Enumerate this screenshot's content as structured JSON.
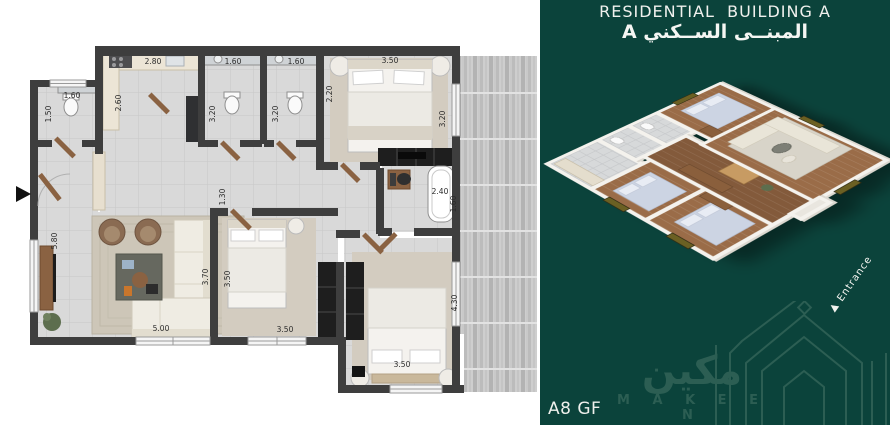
{
  "right_panel": {
    "title_en": "RESIDENTIAL  BUILDING A",
    "title_ar": "المبنــى الســكني A",
    "unit_label": "A8 GF",
    "entrance_label": "Entrance",
    "entrance_arrow": "▲",
    "brand": {
      "name_ar": "مكين",
      "name_en": "M A K E E N"
    },
    "colors": {
      "background": "#0b433b",
      "logo_green": "#2c5e53",
      "text": "#f0f1ee"
    }
  },
  "floor_plan": {
    "wall_color": "#3e3e3e",
    "floor_color": "#d9d9d9",
    "entrance_marker": "right-pointing-triangle",
    "dimensions": [
      {
        "value": "1.60",
        "x": 72,
        "y": 98,
        "rot": 0
      },
      {
        "value": "1.50",
        "x": 51,
        "y": 114,
        "rot": -90
      },
      {
        "value": "2.80",
        "x": 153,
        "y": 64,
        "rot": 0
      },
      {
        "value": "2.60",
        "x": 121,
        "y": 103,
        "rot": -90
      },
      {
        "value": "1.60",
        "x": 233,
        "y": 64,
        "rot": 0
      },
      {
        "value": "3.20",
        "x": 215,
        "y": 114,
        "rot": -90
      },
      {
        "value": "1.60",
        "x": 296,
        "y": 64,
        "rot": 0
      },
      {
        "value": "3.20",
        "x": 278,
        "y": 114,
        "rot": -90
      },
      {
        "value": "3.50",
        "x": 390,
        "y": 63,
        "rot": 0
      },
      {
        "value": "2.20",
        "x": 332,
        "y": 94,
        "rot": -90
      },
      {
        "value": "3.20",
        "x": 445,
        "y": 119,
        "rot": -90
      },
      {
        "value": "1.30",
        "x": 225,
        "y": 197,
        "rot": -90
      },
      {
        "value": "2.40",
        "x": 440,
        "y": 194,
        "rot": 0
      },
      {
        "value": "1.60",
        "x": 456,
        "y": 204,
        "rot": -90
      },
      {
        "value": "5.80",
        "x": 57,
        "y": 241,
        "rot": -90
      },
      {
        "value": "5.00",
        "x": 161,
        "y": 331,
        "rot": 0
      },
      {
        "value": "3.70",
        "x": 208,
        "y": 277,
        "rot": -90
      },
      {
        "value": "3.50",
        "x": 230,
        "y": 279,
        "rot": -90
      },
      {
        "value": "3.50",
        "x": 285,
        "y": 332,
        "rot": 0
      },
      {
        "value": "4.30",
        "x": 457,
        "y": 303,
        "rot": -90
      },
      {
        "value": "3.50",
        "x": 402,
        "y": 367,
        "rot": 0
      }
    ]
  }
}
